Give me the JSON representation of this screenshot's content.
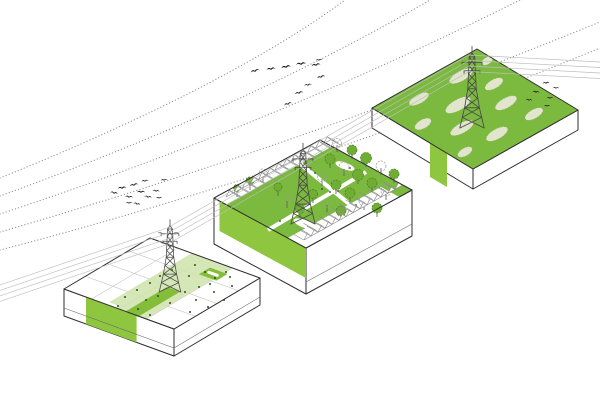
{
  "scene": {
    "background": "#ffffff",
    "description": "Axonometric landscape diagram: three platform blocks under a high-voltage power line corridor with bird migration routes",
    "colors": {
      "green_bright": "#8ec63f",
      "green_mid": "#7cba3f",
      "green_accent": "#83bd3a",
      "green_light": "#cfe3ad",
      "green_pale": "#e0e5cb",
      "outline": "#2e2e2e",
      "wire_gray": "#bdbdbd",
      "dotted_gray": "#8f8f8f",
      "bird_black": "#161616",
      "tree_green": "#6fae33"
    },
    "blocks": [
      {
        "id": "block-strips",
        "description": "left platform: white deck with light green band, bright green strips and pylon"
      },
      {
        "id": "block-park",
        "description": "middle platform: park with crossing paths, trees, ponds, two rows of gabled houses and pylon"
      },
      {
        "id": "block-wetland",
        "description": "right platform: green wetland top with pale reed patches, pylon and landing birds"
      }
    ],
    "migration_routes": [
      "M0,178 Q230,85 345,0",
      "M0,196 Q250,105 430,0",
      "M0,214 Q270,125 520,0",
      "M0,232 Q290,148 600,22",
      "M0,250 Q300,172 600,48"
    ],
    "power_lines": {
      "count": 4,
      "spacing": 5.5,
      "nodes": [
        [
          0,
          285
        ],
        [
          167,
          228
        ],
        [
          300,
          152
        ],
        [
          469,
          55
        ],
        [
          600,
          62
        ]
      ]
    },
    "birds": {
      "flock_upper": [
        [
          255,
          71,
          -14,
          1
        ],
        [
          271,
          69,
          -8,
          1
        ],
        [
          286,
          67,
          -10,
          1.05
        ],
        [
          301,
          64,
          -6,
          1.1
        ],
        [
          316,
          65,
          -10,
          1
        ],
        [
          319,
          60,
          -4,
          0.75
        ],
        [
          321,
          77,
          -14,
          0.9
        ],
        [
          308,
          85,
          -8,
          0.85
        ],
        [
          299,
          93,
          -12,
          0.95
        ],
        [
          288,
          104,
          -16,
          0.9
        ]
      ],
      "flock_left": [
        [
          114,
          193,
          12,
          0.85
        ],
        [
          122,
          188,
          -6,
          0.95
        ],
        [
          129,
          197,
          6,
          0.9
        ],
        [
          134,
          185,
          -12,
          0.95
        ],
        [
          141,
          192,
          0,
          0.9
        ],
        [
          145,
          181,
          -6,
          0.8
        ],
        [
          148,
          197,
          8,
          0.85
        ],
        [
          137,
          204,
          12,
          0.8
        ],
        [
          129,
          203,
          0,
          0.75
        ],
        [
          164,
          180,
          -6,
          0.7
        ],
        [
          156,
          191,
          6,
          0.8
        ],
        [
          159,
          198,
          0,
          0.7
        ]
      ],
      "flock_landing": [
        [
          546,
          83,
          -6,
          0.75
        ],
        [
          556,
          88,
          2,
          0.7
        ],
        [
          536,
          92,
          6,
          0.75
        ],
        [
          550,
          98,
          0,
          0.75
        ],
        [
          529,
          100,
          6,
          0.7
        ],
        [
          547,
          106,
          0,
          0.7
        ]
      ],
      "perched": [
        [
          160,
          233,
          0,
          0.45
        ],
        [
          176,
          233,
          0,
          0.45
        ]
      ]
    },
    "trees": [
      [
        337,
        152,
        4.5,
        0
      ],
      [
        352,
        159,
        5,
        1
      ],
      [
        366,
        167,
        5.5,
        1
      ],
      [
        381,
        175,
        5,
        0
      ],
      [
        394,
        183,
        5,
        1
      ],
      [
        330,
        168,
        5,
        1
      ],
      [
        344,
        176,
        5,
        0
      ],
      [
        358,
        184,
        5.5,
        1
      ],
      [
        372,
        192,
        5,
        1
      ],
      [
        386,
        200,
        5,
        0
      ],
      [
        322,
        186,
        4.5,
        0
      ],
      [
        336,
        194,
        5,
        1
      ],
      [
        350,
        202,
        5,
        1
      ],
      [
        364,
        210,
        5,
        0
      ],
      [
        377,
        217,
        5,
        1
      ],
      [
        313,
        203,
        4.5,
        1
      ],
      [
        327,
        212,
        4.5,
        0
      ],
      [
        341,
        220,
        5,
        1
      ],
      [
        300,
        218,
        4.5,
        1
      ],
      [
        287,
        208,
        4,
        0
      ],
      [
        278,
        196,
        4,
        1
      ],
      [
        237,
        197,
        3.5,
        1
      ],
      [
        250,
        190,
        4,
        1
      ],
      [
        263,
        182,
        4,
        0
      ]
    ],
    "planting_dots": [
      [
        195,
        265
      ],
      [
        205,
        272
      ],
      [
        215,
        278
      ],
      [
        226,
        272
      ],
      [
        189,
        276
      ],
      [
        172,
        270
      ],
      [
        160,
        276
      ],
      [
        150,
        283
      ],
      [
        137,
        290
      ],
      [
        125,
        297
      ],
      [
        118,
        306
      ],
      [
        146,
        300
      ],
      [
        158,
        296
      ],
      [
        170,
        303
      ],
      [
        185,
        292
      ],
      [
        199,
        287
      ],
      [
        210,
        284
      ],
      [
        230,
        277
      ],
      [
        138,
        309
      ],
      [
        150,
        315
      ],
      [
        196,
        300
      ],
      [
        214,
        292
      ],
      [
        232,
        286
      ],
      [
        208,
        307
      ],
      [
        190,
        312
      ],
      [
        224,
        300
      ]
    ],
    "path_dots": [
      [
        315,
        173
      ],
      [
        338,
        191
      ],
      [
        356,
        205
      ],
      [
        350,
        168
      ],
      [
        322,
        189
      ],
      [
        300,
        206
      ],
      [
        280,
        221
      ],
      [
        330,
        192
      ]
    ],
    "reed_patches": [
      [
        487,
        61,
        6,
        3.5
      ],
      [
        461,
        76,
        13,
        5
      ],
      [
        419,
        99,
        11,
        4.5
      ],
      [
        494,
        84,
        10,
        4.5
      ],
      [
        458,
        105,
        14,
        5.5
      ],
      [
        423,
        124,
        9,
        4.5
      ],
      [
        506,
        103,
        12,
        5
      ],
      [
        462,
        128,
        13,
        5
      ],
      [
        534,
        114,
        10,
        4.5
      ],
      [
        497,
        134,
        12,
        5
      ],
      [
        465,
        152,
        8,
        4
      ]
    ],
    "house_rows": [
      {
        "start": [
          226,
          197
        ],
        "step": [
          8.15,
          -4.46
        ],
        "count": 13,
        "symbol": "houseA"
      },
      {
        "start": [
          304,
          240
        ],
        "step": [
          7,
          -3.9
        ],
        "count": 14,
        "symbol": "houseB"
      }
    ]
  }
}
